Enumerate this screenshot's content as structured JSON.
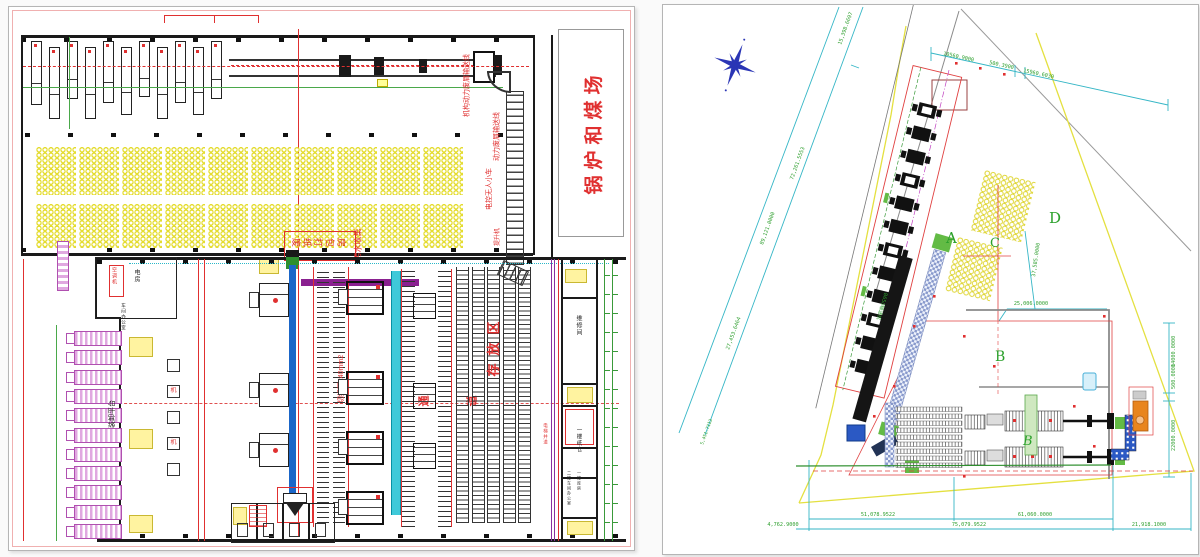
{
  "left_sheet": {
    "labels": {
      "boiler_yard": "锅炉和煤场",
      "conveyor1": "机构动力废屑输送线",
      "conveyor2": "动力废屑输送线",
      "agv": "电控无人小车",
      "hoist": "提升机",
      "baling_room": "废纸打包房",
      "sewage": "污水收集",
      "aircon": "空调机",
      "power_room": "电房",
      "office": "车间办公室",
      "loading_platform": "装卸平台",
      "machine_char": "机",
      "cutting_area": "切纸区240mm2",
      "storage_area": "存放区",
      "aisle_1": "通",
      "aisle_2": "道",
      "maintenance": "维修间",
      "paper_store": "一楼纸仓",
      "office_2f": "二楼车间办公室",
      "store_1f": "一楼库房",
      "elevator": "电梯井道"
    },
    "pile_grid": {
      "columns": 10,
      "rows": 2
    },
    "truck_count": 11,
    "top_machine_count": 11,
    "big_rack_strips": 5
  },
  "right_sheet": {
    "zones": {
      "a": "A",
      "b": "B",
      "b_italic": "B",
      "c": "C",
      "d": "D"
    },
    "conveyor_label": "B650输送机",
    "dims": {
      "top_left": "15,398.6697",
      "left_inner": "72,261.5553",
      "left_outer": "89,121.0000",
      "left_lower": "27,453.6464",
      "left_small": "5,451.7113",
      "top_1": "10560.9000",
      "top_2": "500.3900",
      "top_3": "15960.6030",
      "c_area": "37,585.0000",
      "d_top": "25,006.0000",
      "right_1": "14000.0000",
      "right_2": "500.0000",
      "right_3": "22000.0000",
      "bottom_1": "51,078.9522",
      "bottom_2": "61,060.0000",
      "bottom_left": "4,762.9000",
      "bottom_mid": "75,079.9522",
      "bottom_right": "21,918.1000"
    },
    "building_a_machine_count": 12
  },
  "colors": {
    "red": "#e03030",
    "green": "#2e9f2e",
    "cyan": "#35b6c6",
    "yellow": "#e4dc30",
    "blue": "#1b66c8",
    "magenta": "#b050b0",
    "orange": "#e8851e"
  }
}
